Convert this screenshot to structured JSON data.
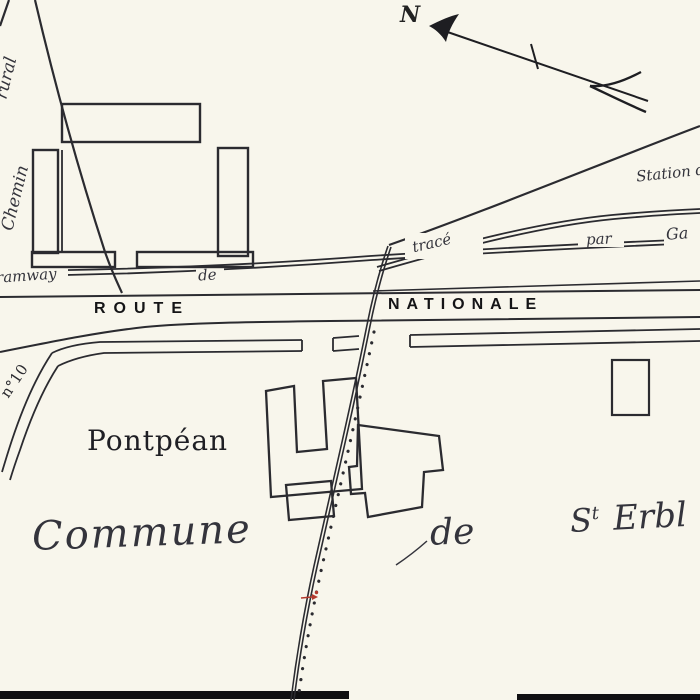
{
  "colors": {
    "background": "#f8f6ec",
    "ink": "#2b2b30",
    "label": "#1c1c20",
    "red_mark": "#b43a2e"
  },
  "compass": {
    "north_label": "N"
  },
  "railway": {
    "station_label": "Station d",
    "tramway_label": "Tramway",
    "tramway_de_label": "de",
    "trace_label": "tracé",
    "par_label": "par",
    "gare_label": "Ga"
  },
  "roads": {
    "route_label": "ROUTE",
    "nationale_label": "NATIONALE",
    "chemin_label": "Chemin",
    "rural_label": "rural",
    "road_number_label": "n°10"
  },
  "places": {
    "village_label": "Pontpéan",
    "commune_label": "Commune",
    "commune_de_label": "de",
    "saint_initial_label": "S",
    "saint_sup_label": "t",
    "saint_name_label": "Erbl"
  }
}
